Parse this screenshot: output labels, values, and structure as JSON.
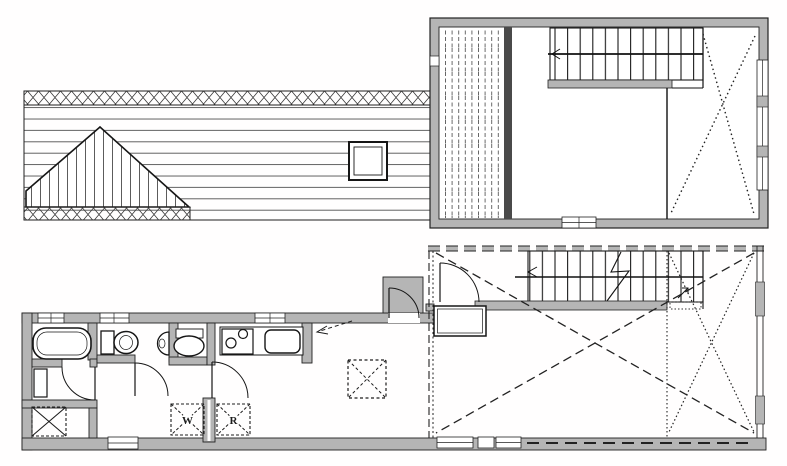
{
  "document": {
    "kind": "scanned architectural floor plan, two stories",
    "floors": [
      {
        "name": "upper floor / roof plan",
        "features": [
          "roof plan with ridge cross-hatching",
          "gable dormer with vertical boarding",
          "skylight",
          "balcony deck with plank stripes",
          "staircase",
          "open void marked with dotted X",
          "side wall windows",
          "rear wall window"
        ]
      },
      {
        "name": "ground floor plan",
        "features": [
          "bathroom with bathtub",
          "changing room with cabinet",
          "storage nook marked with X",
          "toilet with corner basin",
          "washbasin alcove",
          "kitchen with two-burner stove and sink",
          "washing machine space",
          "refrigerator space",
          "living-dining room with dashed floor hatch",
          "entry porch with swing door",
          "genkan entry step",
          "staircase with break line",
          "covered open area marked with dashed X",
          "windows"
        ]
      }
    ],
    "labels": {
      "washer": "W",
      "refrigerator": "R"
    },
    "colors": {
      "background": "#ffffff",
      "wall_fill": "#b5b5b5",
      "line": "#1f1f1f",
      "pattern_line": "#4a4a4a"
    }
  }
}
